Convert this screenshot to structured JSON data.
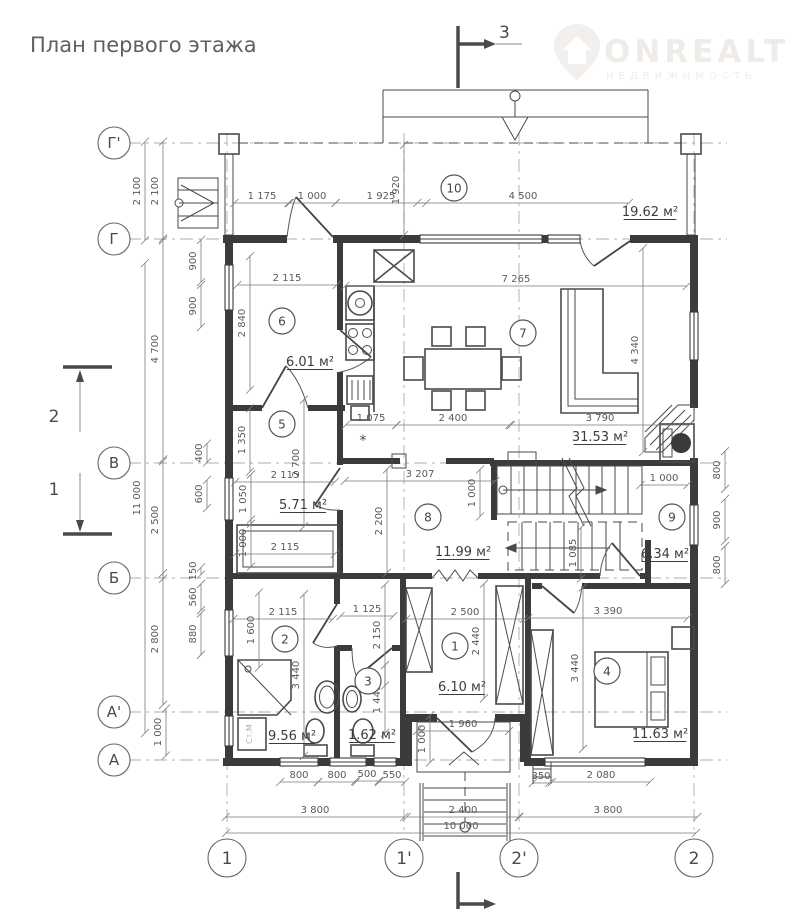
{
  "title": "План первого этажа",
  "watermark": {
    "brand": "ONREALT",
    "subtitle": "НЕДВИЖИМОСТЬ"
  },
  "drawing": {
    "sections": {
      "top": "3",
      "bottom": "",
      "left_upper": "2",
      "left_lower": "1"
    },
    "axes": {
      "horizontal": [
        {
          "label": "Г'",
          "y": 143
        },
        {
          "label": "Г",
          "y": 239
        },
        {
          "label": "В",
          "y": 463
        },
        {
          "label": "Б",
          "y": 578
        },
        {
          "label": "А'",
          "y": 712
        },
        {
          "label": "А",
          "y": 760
        }
      ],
      "vertical": [
        {
          "label": "1",
          "x": 227
        },
        {
          "label": "1'",
          "x": 404
        },
        {
          "label": "2'",
          "x": 519
        },
        {
          "label": "2",
          "x": 694
        }
      ]
    },
    "rooms": [
      {
        "num": "1",
        "area": "6.10 м²",
        "cx": 455,
        "cy": 646,
        "ax": 462,
        "ay": 691
      },
      {
        "num": "2",
        "area": "9.56 м²",
        "cx": 285,
        "cy": 639,
        "ax": 292,
        "ay": 740
      },
      {
        "num": "3",
        "area": "1.62 м²",
        "cx": 368,
        "cy": 681,
        "ax": 372,
        "ay": 739
      },
      {
        "num": "4",
        "area": "11.63 м²",
        "cx": 607,
        "cy": 671,
        "ax": 660,
        "ay": 738
      },
      {
        "num": "5",
        "area": "5.71 м²",
        "cx": 282,
        "cy": 424,
        "ax": 303,
        "ay": 509
      },
      {
        "num": "6",
        "area": "6.01 м²",
        "cx": 282,
        "cy": 321,
        "ax": 310,
        "ay": 366
      },
      {
        "num": "7",
        "area": "31.53 м²",
        "cx": 523,
        "cy": 333,
        "ax": 600,
        "ay": 441
      },
      {
        "num": "8",
        "area": "11.99 м²",
        "cx": 428,
        "cy": 517,
        "ax": 463,
        "ay": 556
      },
      {
        "num": "9",
        "area": "6.34 м²",
        "cx": 672,
        "cy": 517,
        "ax": 665,
        "ay": 558
      },
      {
        "num": "10",
        "area": "19.62 м²",
        "cx": 454,
        "cy": 188,
        "ax": 650,
        "ay": 216
      }
    ],
    "dims": [
      [
        "1 175",
        262,
        199,
        "h"
      ],
      [
        "1 000",
        312,
        199,
        "h"
      ],
      [
        "1 925",
        381,
        199,
        "h"
      ],
      [
        "4 500",
        523,
        199,
        "h"
      ],
      [
        "7 265",
        516,
        282,
        "h"
      ],
      [
        "2 115",
        287,
        281,
        "h"
      ],
      [
        "1 075",
        371,
        421,
        "h"
      ],
      [
        "2 400",
        453,
        421,
        "h"
      ],
      [
        "3 790",
        600,
        421,
        "h"
      ],
      [
        "3 207",
        420,
        477,
        "h"
      ],
      [
        "2 115",
        285,
        478,
        "h"
      ],
      [
        "2 115",
        285,
        550,
        "h"
      ],
      [
        "1 000",
        664,
        481,
        "h"
      ],
      [
        "2 115",
        283,
        615,
        "h"
      ],
      [
        "1 125",
        367,
        612,
        "h"
      ],
      [
        "2 500",
        465,
        615,
        "h"
      ],
      [
        "3 390",
        608,
        614,
        "h"
      ],
      [
        "1 960",
        463,
        727,
        "h"
      ],
      [
        "800",
        299,
        778,
        "h"
      ],
      [
        "800",
        337,
        778,
        "h"
      ],
      [
        "500",
        367,
        777,
        "h"
      ],
      [
        "550",
        392,
        778,
        "h"
      ],
      [
        "350",
        541,
        779,
        "h"
      ],
      [
        "2 080",
        601,
        778,
        "h"
      ],
      [
        "3 800",
        315,
        813,
        "h"
      ],
      [
        "2 400",
        463,
        813,
        "h"
      ],
      [
        "3 800",
        608,
        813,
        "h"
      ],
      [
        "10 000",
        461,
        829,
        "h"
      ],
      [
        "2 100",
        140,
        191,
        "v"
      ],
      [
        "2 100",
        158,
        191,
        "v"
      ],
      [
        "4 700",
        158,
        349,
        "v"
      ],
      [
        "11 000",
        140,
        498,
        "v"
      ],
      [
        "2 500",
        158,
        520,
        "v"
      ],
      [
        "2 800",
        158,
        639,
        "v"
      ],
      [
        "1 000",
        161,
        732,
        "v"
      ],
      [
        "900",
        196,
        261,
        "v"
      ],
      [
        "900",
        196,
        306,
        "v"
      ],
      [
        "400",
        202,
        453,
        "v"
      ],
      [
        "600",
        202,
        494,
        "v"
      ],
      [
        "150",
        196,
        571,
        "v"
      ],
      [
        "560",
        196,
        597,
        "v"
      ],
      [
        "880",
        196,
        634,
        "v"
      ],
      [
        "1 920",
        399,
        190,
        "v"
      ],
      [
        "2 840",
        245,
        323,
        "v"
      ],
      [
        "1 350",
        245,
        440,
        "v"
      ],
      [
        "2 700",
        299,
        463,
        "v"
      ],
      [
        "1 050",
        246,
        499,
        "v"
      ],
      [
        "1 000",
        246,
        543,
        "v"
      ],
      [
        "2 200",
        382,
        521,
        "v"
      ],
      [
        "1 000",
        475,
        493,
        "v"
      ],
      [
        "4 340",
        638,
        350,
        "v"
      ],
      [
        "1 085",
        576,
        553,
        "v"
      ],
      [
        "800",
        720,
        470,
        "v"
      ],
      [
        "900",
        720,
        520,
        "v"
      ],
      [
        "800",
        720,
        565,
        "v"
      ],
      [
        "1 600",
        254,
        630,
        "v"
      ],
      [
        "3 440",
        299,
        675,
        "v"
      ],
      [
        "2 150",
        380,
        635,
        "v"
      ],
      [
        "1 440",
        380,
        699,
        "v"
      ],
      [
        "2 440",
        479,
        641,
        "v"
      ],
      [
        "3 440",
        578,
        668,
        "v"
      ],
      [
        "1 000",
        425,
        739,
        "v"
      ]
    ],
    "labels": [
      [
        "Ст.М",
        252,
        734,
        -90,
        8,
        "#b3aea9"
      ],
      [
        "*",
        363,
        445,
        0,
        14,
        "#4a4a4a"
      ]
    ]
  }
}
